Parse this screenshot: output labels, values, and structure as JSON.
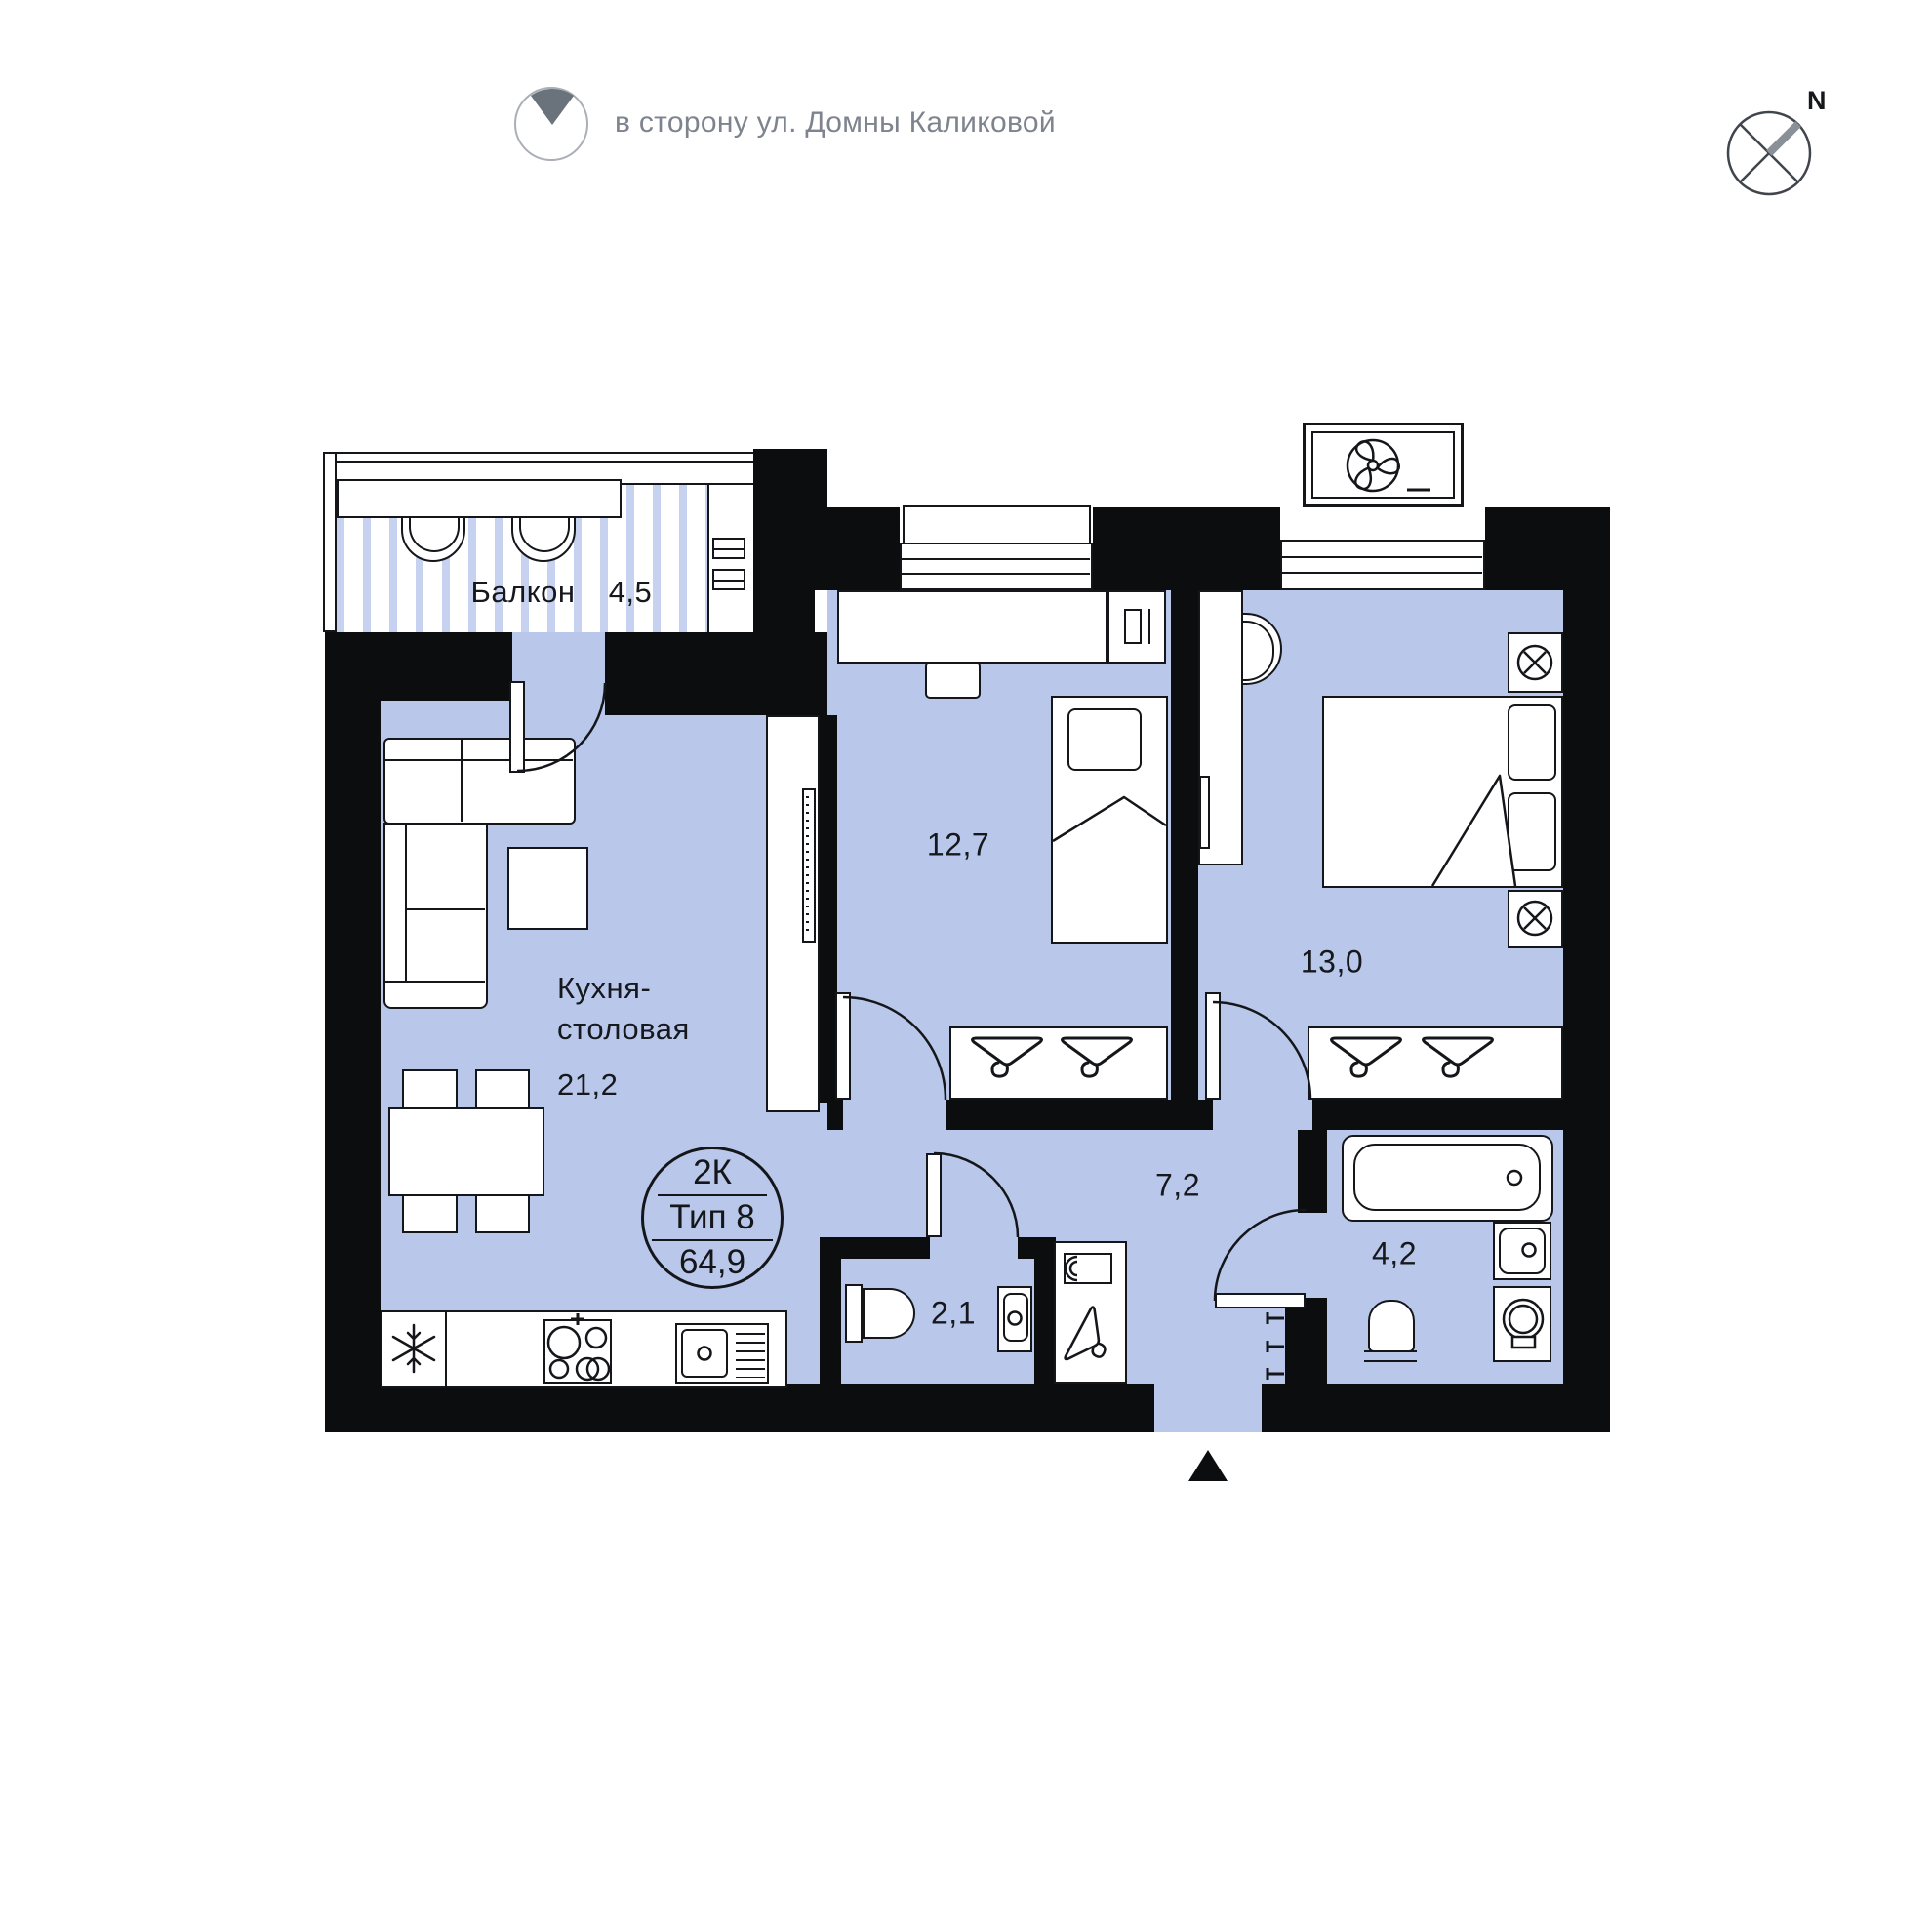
{
  "header": {
    "direction_text": "в сторону ул. Домны Каликовой",
    "compass_label": "N"
  },
  "badge": {
    "rooms": "2К",
    "type": "Тип 8",
    "total_area": "64,9"
  },
  "rooms": {
    "balcony": {
      "name": "Балкон",
      "area": "4,5"
    },
    "kitchen": {
      "name_line1": "Кухня-",
      "name_line2": "столовая",
      "area": "21,2"
    },
    "bedroom1": {
      "area": "12,7"
    },
    "bedroom2": {
      "area": "13,0"
    },
    "hallway": {
      "area": "7,2"
    },
    "wc": {
      "area": "2,1"
    },
    "bathroom": {
      "area": "4,2"
    }
  },
  "colors": {
    "floor": "#b9c8ea",
    "wall": "#0c0d0f",
    "balcony_stripe": "#c6d2ef",
    "muted_text": "#7e848d",
    "dark_text": "#16181d"
  }
}
